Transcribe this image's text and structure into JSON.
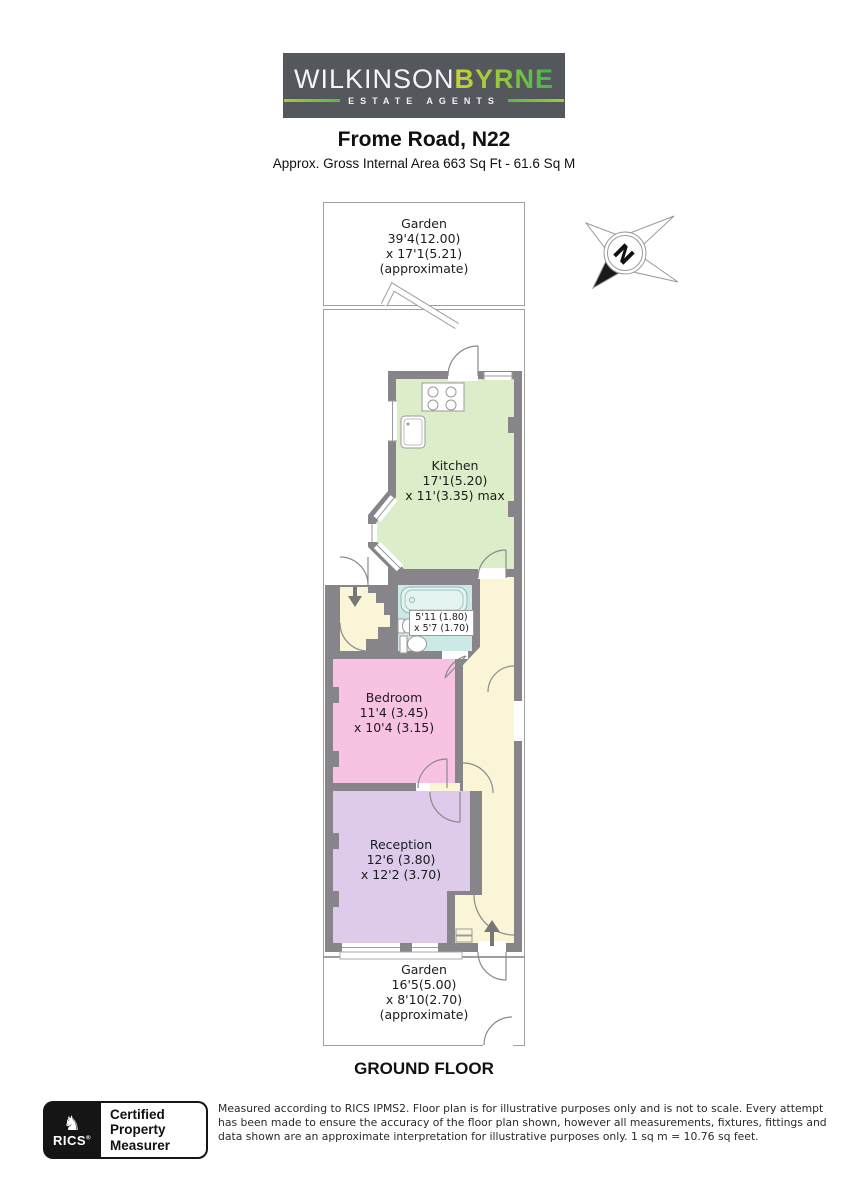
{
  "logo": {
    "brand_top_1": "WILKINSON",
    "brand_top_2": "BYRNE",
    "tagline": "ESTATE AGENTS"
  },
  "header": {
    "title": "Frome Road, N22",
    "subtitle": "Approx. Gross Internal Area 663 Sq Ft - 61.6 Sq M"
  },
  "floorplan": {
    "garden_top": {
      "name": "Garden",
      "dim1": "39'4(12.00)",
      "dim2": "x 17'1(5.21)",
      "note": "(approximate)"
    },
    "kitchen": {
      "name": "Kitchen",
      "dim1": "17'1(5.20)",
      "dim2": "x 11'(3.35) max"
    },
    "bathroom": {
      "dim1": "5'11 (1.80)",
      "dim2": "x 5'7 (1.70)"
    },
    "bedroom": {
      "name": "Bedroom",
      "dim1": "11'4 (3.45)",
      "dim2": "x 10'4 (3.15)"
    },
    "reception": {
      "name": "Reception",
      "dim1": "12'6 (3.80)",
      "dim2": "x 12'2 (3.70)"
    },
    "garden_bottom": {
      "name": "Garden",
      "dim1": "16'5(5.00)",
      "dim2": "x 8'10(2.70)",
      "note": "(approximate)"
    },
    "floor_label": "GROUND FLOOR",
    "compass_letter": "N"
  },
  "footer": {
    "rics_acronym": "RICS",
    "registered_mark": "®",
    "badge_lines": [
      "Certified",
      "Property",
      "Measurer"
    ],
    "disclaimer_lines": [
      "Measured according to RICS IPMS2. Floor plan is for illustrative purposes only and is not to scale. Every attempt",
      "has been made to ensure the accuracy of the floor plan shown, however all measurements, fixtures, fittings and",
      "data shown are an approximate interpretation for illustrative purposes only. 1 sq m = 10.76 sq feet."
    ]
  },
  "colors": {
    "wall": "#878589",
    "kitchen": "#DCEDC9",
    "bathroom": "#CDE9E6",
    "bedroom": "#F8C3E2",
    "reception": "#DECAEA",
    "hallway": "#FBF5D7",
    "logo_background": "#54575B",
    "logo_green_start": "#B9CC34",
    "logo_green_end": "#3FB549"
  }
}
